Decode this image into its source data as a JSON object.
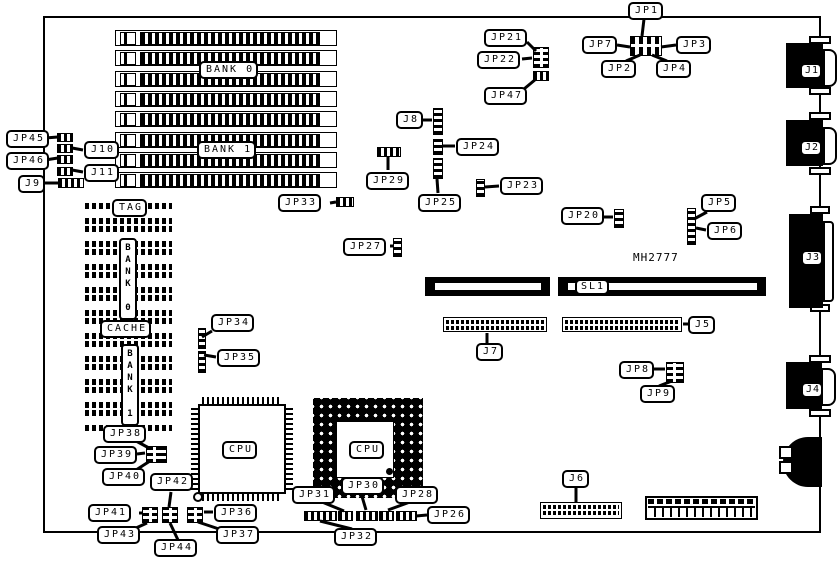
{
  "board": {
    "part_number": "MH2777",
    "memory": {
      "bank0": "BANK 0",
      "bank1": "BANK 1",
      "simm_socket_count": 8
    },
    "cache": {
      "tag": "TAG",
      "bank0": "BANK 0",
      "label": "CACHE",
      "bank1": "BANK 1",
      "chip_count": 9
    },
    "cpus": {
      "qfp": "CPU",
      "pga": "CPU"
    },
    "slot": {
      "sl1": "SL1"
    },
    "connectors": {
      "j1": "J1",
      "j2": "J2",
      "j3": "J3",
      "j4": "J4",
      "j5": "J5",
      "j6": "J6",
      "j7": "J7",
      "j8": "J8",
      "j9": "J9",
      "j10": "J10",
      "j11": "J11"
    },
    "jumpers": {
      "jp1": "JP1",
      "jp2": "JP2",
      "jp3": "JP3",
      "jp4": "JP4",
      "jp5": "JP5",
      "jp6": "JP6",
      "jp7": "JP7",
      "jp8": "JP8",
      "jp9": "JP9",
      "jp20": "JP20",
      "jp21": "JP21",
      "jp22": "JP22",
      "jp23": "JP23",
      "jp24": "JP24",
      "jp25": "JP25",
      "jp26": "JP26",
      "jp27": "JP27",
      "jp28": "JP28",
      "jp29": "JP29",
      "jp30": "JP30",
      "jp31": "JP31",
      "jp32": "JP32",
      "jp33": "JP33",
      "jp34": "JP34",
      "jp35": "JP35",
      "jp36": "JP36",
      "jp37": "JP37",
      "jp38": "JP38",
      "jp39": "JP39",
      "jp40": "JP40",
      "jp41": "JP41",
      "jp42": "JP42",
      "jp43": "JP43",
      "jp44": "JP44",
      "jp45": "JP45",
      "jp46": "JP46",
      "jp47": "JP47"
    }
  }
}
